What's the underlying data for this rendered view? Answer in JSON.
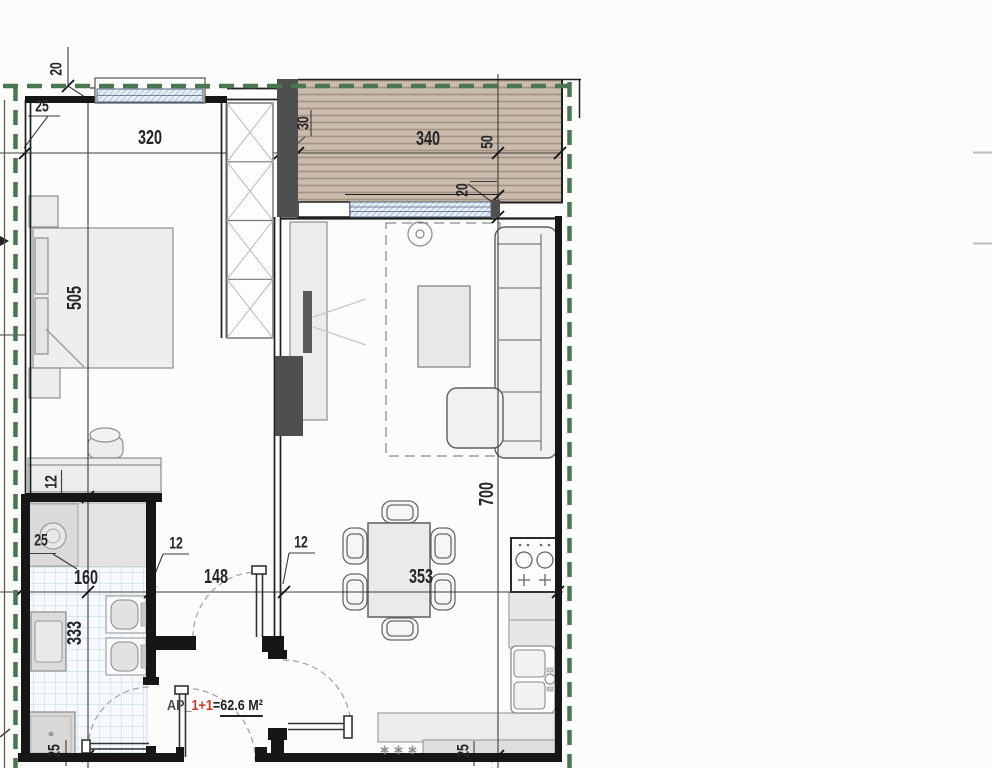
{
  "title": "Apartment floor plan",
  "area_label": {
    "prefix": "AP",
    "separator": "_",
    "units": "1+1",
    "equals": "=",
    "area": "62.6 M²"
  },
  "dimensions": {
    "top_offset": "20",
    "left_wall": "25",
    "bedroom_width": "320",
    "column_width": "30",
    "terrace_width": "340",
    "terrace_edge": "50",
    "window_wall": "20",
    "bedroom_depth": "505",
    "bedroom_wall": "12",
    "bath_niche": "25",
    "bath_width": "160",
    "bath_depth": "333",
    "hall_wall_left": "12",
    "hall_wall_right": "12",
    "hall_width": "148",
    "living_width": "353",
    "living_depth": "700",
    "shower_width": "25",
    "counter_depth": "25"
  },
  "symbols": {
    "fridge_marker": "∗∗∗"
  },
  "colors": {
    "wall_dark_fill": "#4f4f4f",
    "wall_black": "#161616",
    "green_boundary": "#4a7752",
    "terrace_fill": "#c9bbad",
    "terrace_stripe": "#a2927f",
    "window_glass": "#e8f0f7",
    "window_hatch": "#b9cde0",
    "tile_grid": "#bfd2e4",
    "furniture_fill": "#ececec",
    "red_accent": "#c23b2c"
  }
}
